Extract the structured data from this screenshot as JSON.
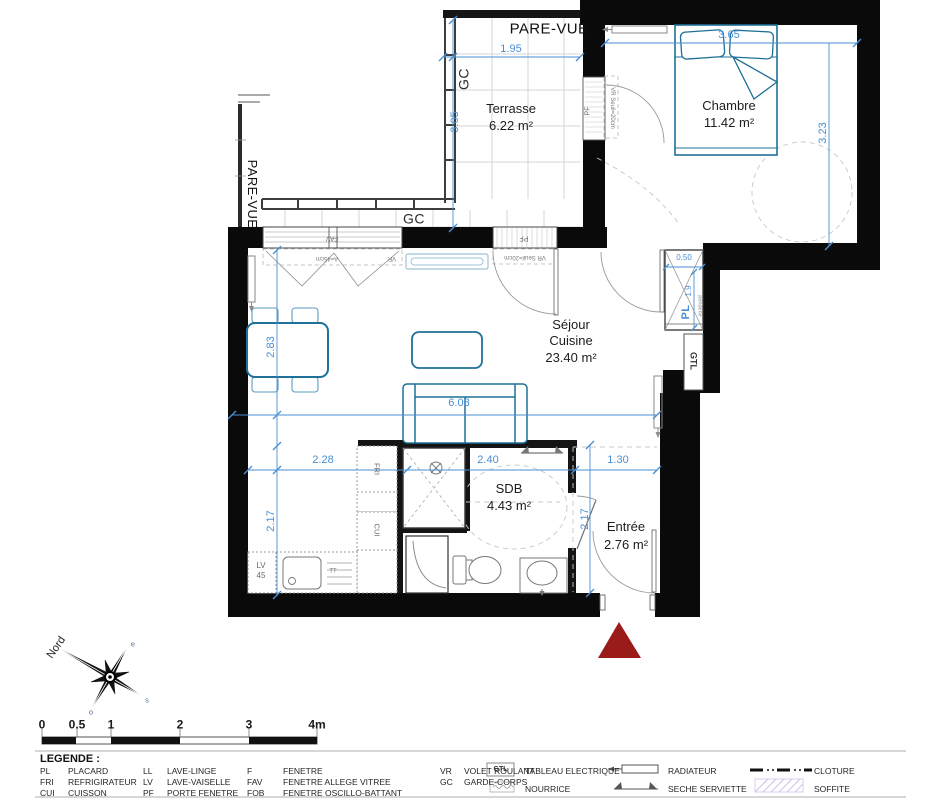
{
  "colors": {
    "wall_black": "#0a0a0a",
    "dimension_blue": "#4a8fd3",
    "furniture_teal": "#1f7098",
    "fixture_gray": "#8a8a8a",
    "triangle_red": "#9b1b1b",
    "soffite_lilac": "#cfc0ea"
  },
  "rooms": {
    "terrasse": {
      "name": "Terrasse",
      "area": "6.22 m²"
    },
    "chambre": {
      "name": "Chambre",
      "area": "11.42 m²"
    },
    "sejour": {
      "line1": "Séjour",
      "line2": "Cuisine",
      "area": "23.40 m²"
    },
    "sdb": {
      "name": "SDB",
      "area": "4.43 m²"
    },
    "entree": {
      "name": "Entrée",
      "area": "2.76 m²"
    }
  },
  "dims": {
    "terrace_w": "1.95",
    "terrace_h": "3.05",
    "chambre_w": "3.65",
    "chambre_h": "3.23",
    "sejour_left": "2.83",
    "sejour_w": "6.08",
    "kitchen_w": "2.28",
    "sdb_w": "2.40",
    "entree_w": "1.30",
    "kitchen_h": "2.17",
    "entree_h": "2.17",
    "placard_w": "0.50",
    "placard_h": "1.9"
  },
  "labels": {
    "pare_vue_top": "PARE-VUE",
    "pare_vue_left": "PARE-VUE",
    "gc_left": "GC",
    "gc_bottom": "GC",
    "fav": "FAV",
    "fav_allege": "A=45cm",
    "vr": "VR",
    "pf": "PF",
    "vr_seuil": "VR Seuil=20cm",
    "pf_chambre": "PF",
    "vr_seuil_chambre": "VR Seuil=20cm",
    "fri": "FRI",
    "cui": "CUI",
    "lv": "LV",
    "lv_size": "45",
    "tt": "TT",
    "pl": "PL",
    "penderie": "penderie",
    "gtl": "GTL"
  },
  "compass": {
    "north": "Nord",
    "east": "e",
    "south": "s",
    "west": "o"
  },
  "scale": {
    "ticks": [
      "0",
      "0.5",
      "1",
      "2",
      "3",
      "4m"
    ]
  },
  "legend": {
    "title": "LEGENDE :",
    "col1": [
      {
        "abbr": "PL",
        "label": "PLACARD"
      },
      {
        "abbr": "FRI",
        "label": "REFRIGIRATEUR"
      },
      {
        "abbr": "CUI",
        "label": "CUISSON"
      }
    ],
    "col2": [
      {
        "abbr": "LL",
        "label": "LAVE-LINGE"
      },
      {
        "abbr": "LV",
        "label": "LAVE-VAISELLE"
      },
      {
        "abbr": "PF",
        "label": "PORTE FENETRE"
      }
    ],
    "col3": [
      {
        "abbr": "F",
        "label": "FENETRE"
      },
      {
        "abbr": "FAV",
        "label": "FENETRE ALLEGE VITREE"
      },
      {
        "abbr": "FOB",
        "label": "FENETRE OSCILLO-BATTANT"
      }
    ],
    "col4": [
      {
        "abbr": "VR",
        "label": "VOLET ROULANT"
      },
      {
        "abbr": "GC",
        "label": "GARDE-CORPS"
      }
    ],
    "electrical": [
      {
        "symbol": "GTL",
        "label": "TABLEAU ELECTRIQUE"
      },
      {
        "symbol": "",
        "label": "NOURRICE"
      }
    ],
    "heating": [
      {
        "label": "RADIATEUR"
      },
      {
        "label": "SECHE SERVIETTE"
      }
    ],
    "misc": [
      {
        "label": "CLOTURE"
      },
      {
        "label": "SOFFITE"
      }
    ]
  }
}
